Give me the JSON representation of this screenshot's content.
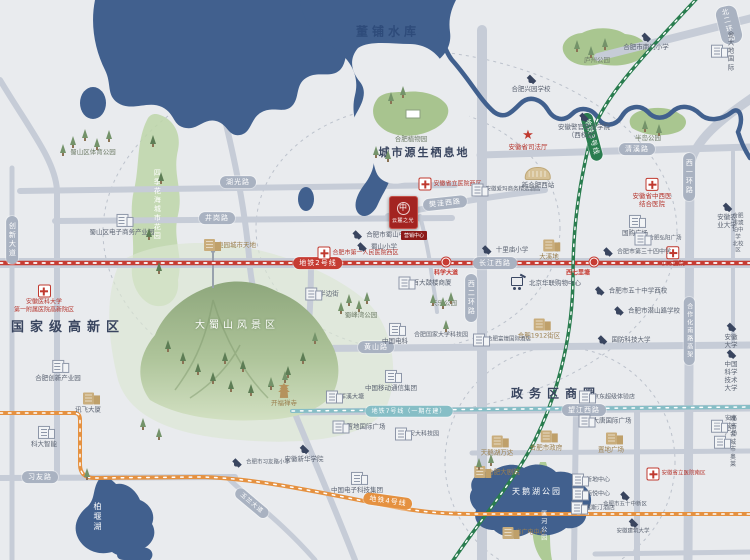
{
  "palette": {
    "land": "#e9ebee",
    "water": "#41608e",
    "road": "#c6ccd7",
    "green": "#aecb96",
    "metro2_red": "#c63c33",
    "metro3_green": "#2a7d4f",
    "metro4_orange": "#e59140",
    "metro7_teal": "#86bec6",
    "pill_gray": "#a9b2c1",
    "navy_text": "#39455f",
    "hospital_red": "#b5342c",
    "tan": "#c9ad7c"
  },
  "project": {
    "logo_mark": "中",
    "logo_title": "云麓之光",
    "tag": "营销中心"
  },
  "labels": [
    {
      "t": "董铺水库",
      "x": 388,
      "y": 32,
      "c": "water-big",
      "n": "dongpu-reservoir-label"
    },
    {
      "t": "城市源生栖息地",
      "x": 424,
      "y": 153,
      "c": "habitat",
      "n": "habitat-label"
    },
    {
      "t": "国家级高新区",
      "x": 68,
      "y": 328,
      "c": "area",
      "n": "hitech-zone-label"
    },
    {
      "t": "政务区商圈",
      "x": 556,
      "y": 394,
      "c": "area",
      "fs": 12,
      "n": "government-district-label"
    },
    {
      "t": "大蜀山风景区",
      "x": 237,
      "y": 326,
      "c": "big-park",
      "n": "dashushan-label"
    },
    {
      "t": "天鹅湖公园",
      "x": 537,
      "y": 492,
      "c": "wht sp2",
      "fs": 8,
      "n": "swan-lake-label"
    },
    {
      "t": "柏堰湖",
      "x": 97,
      "y": 517,
      "c": "wht v",
      "fs": 8,
      "n": "baiyan-lake-label"
    },
    {
      "t": "匡河公园",
      "x": 543,
      "y": 526,
      "c": "wht v",
      "fs": 6,
      "n": "kuanghe-park-label"
    },
    {
      "t": "四季花海城市花园",
      "x": 157,
      "y": 205,
      "c": "wht v",
      "fs": 7,
      "n": "flower-sea-garden-label"
    },
    {
      "t": "湖光路",
      "x": 238,
      "y": 182,
      "c": "pill",
      "n": "road-huguang-label"
    },
    {
      "t": "井岗路",
      "x": 217,
      "y": 218,
      "c": "pill",
      "n": "road-jinggang-label"
    },
    {
      "t": "长江西路",
      "x": 495,
      "y": 263,
      "c": "pill",
      "n": "road-changjiangxi-label"
    },
    {
      "t": "清溪路",
      "x": 637,
      "y": 149,
      "c": "pill",
      "n": "road-qingxi-label"
    },
    {
      "t": "樊洼西路",
      "x": 445,
      "y": 203,
      "c": "pill",
      "r": -6,
      "n": "road-fanwaxi-label"
    },
    {
      "t": "黄山路",
      "x": 376,
      "y": 347,
      "c": "pill",
      "n": "road-huangshan-label"
    },
    {
      "t": "望江西路",
      "x": 584,
      "y": 410,
      "c": "pill",
      "n": "road-wangjiangxi-label"
    },
    {
      "t": "习友路",
      "x": 40,
      "y": 477,
      "c": "pill",
      "n": "road-xiyou-label"
    },
    {
      "t": "北二环路",
      "x": 729,
      "y": 25,
      "c": "pill",
      "r": -14,
      "n": "road-beierhuan-label"
    },
    {
      "t": "西二环路",
      "x": 471,
      "y": 298,
      "c": "pill v",
      "n": "road-xierhuan-label"
    },
    {
      "t": "西一环路",
      "x": 689,
      "y": 177,
      "c": "pill v",
      "n": "road-xiyihuan-label"
    },
    {
      "t": "合作化南路高架",
      "x": 689,
      "y": 331,
      "c": "pill v",
      "fs": 6,
      "n": "road-hezuohua-label"
    },
    {
      "t": "创新大道",
      "x": 12,
      "y": 240,
      "c": "pill v",
      "n": "road-chuangxin-label"
    },
    {
      "t": "玉兰大道",
      "x": 252,
      "y": 503,
      "c": "pill",
      "r": 40,
      "fs": 6,
      "n": "road-yulan-label"
    },
    {
      "t": "地铁2号线",
      "x": 318,
      "y": 263,
      "c": "pill m2",
      "n": "metro-line2-badge"
    },
    {
      "t": "地铁3号线",
      "x": 592,
      "y": 137,
      "c": "pill m3",
      "r": 75,
      "n": "metro-line3-badge"
    },
    {
      "t": "地铁4号线",
      "x": 388,
      "y": 501,
      "c": "pill m4",
      "r": 8,
      "n": "metro-line4-badge"
    },
    {
      "t": "地铁7号线（一期在建）",
      "x": 409,
      "y": 411,
      "c": "pill m7",
      "fs": 6,
      "n": "metro-line7-badge"
    },
    {
      "t": "",
      "x": 446,
      "y": 262,
      "i": "stn",
      "n": "station-dot-kexuedadao"
    },
    {
      "t": "",
      "x": 594,
      "y": 262,
      "i": "stn",
      "n": "station-dot-xiqilitang"
    },
    {
      "t": "科学大道",
      "x": 446,
      "y": 273,
      "c": "stn-lbl",
      "n": "station-kexuedadao-label"
    },
    {
      "t": "西七里塘",
      "x": 578,
      "y": 273,
      "c": "stn-lbl",
      "n": "station-xiqilitang-label"
    },
    {
      "t": "安徽医科大学\n第一附属医院高新院区",
      "x": 44,
      "y": 299,
      "c": "red",
      "fs": 6,
      "i": "cross",
      "ip": "top",
      "n": "hospital-anyida-label"
    },
    {
      "t": "合肥市第一人民医院西区",
      "x": 358,
      "y": 253,
      "c": "red",
      "fs": 6,
      "i": "cross",
      "n": "hospital-first-people-label"
    },
    {
      "t": "安徽省立医院西区",
      "x": 450,
      "y": 184,
      "c": "red",
      "fs": 6,
      "i": "cross",
      "n": "hospital-shengli-west-label"
    },
    {
      "t": "安徽省中西医\n结合医院",
      "x": 652,
      "y": 193,
      "c": "red",
      "fs": 6.5,
      "i": "cross",
      "ip": "top",
      "n": "hospital-zhongxiyi-label"
    },
    {
      "t": "105医院",
      "x": 673,
      "y": 257,
      "c": "red",
      "fs": 6,
      "i": "cross",
      "ip": "top",
      "n": "hospital-105-label"
    },
    {
      "t": "安徽省立医院南区",
      "x": 676,
      "y": 474,
      "c": "red",
      "fs": 5.5,
      "i": "cross",
      "n": "hospital-shengli-south-label"
    },
    {
      "t": "安徽省司法厅",
      "x": 528,
      "y": 140,
      "c": "red",
      "fs": 6.5,
      "i": "star",
      "ip": "top",
      "n": "justice-dept-label"
    },
    {
      "t": "合肥市南门小学",
      "x": 646,
      "y": 42,
      "i": "cap",
      "ip": "top",
      "n": "school-nanmen-label"
    },
    {
      "t": "合肥兴园学校",
      "x": 531,
      "y": 84,
      "i": "cap",
      "ip": "top",
      "n": "school-xingyuan-label"
    },
    {
      "t": "安徽警官职业学院\n（西校区）",
      "x": 584,
      "y": 126,
      "i": "cap",
      "ip": "top",
      "n": "school-police-college-label"
    },
    {
      "t": "合肥市蜀山中学",
      "x": 381,
      "y": 235,
      "i": "cap",
      "n": "school-shushan-middle-label"
    },
    {
      "t": "蜀山小学",
      "x": 376,
      "y": 247,
      "i": "cap",
      "n": "school-shushan-primary-label"
    },
    {
      "t": "十里庙小学",
      "x": 504,
      "y": 250,
      "i": "cap",
      "n": "school-shilimiao-label"
    },
    {
      "t": "合肥市第三十四中学",
      "x": 636,
      "y": 252,
      "fs": 6,
      "i": "cap",
      "n": "school-no34-label"
    },
    {
      "t": "合肥市五十中学西校",
      "x": 630,
      "y": 291,
      "i": "cap",
      "n": "school-no50-west-label"
    },
    {
      "t": "合肥市潜山路学校",
      "x": 646,
      "y": 311,
      "i": "cap",
      "n": "school-qianshanlu-label"
    },
    {
      "t": "国防科技大学",
      "x": 623,
      "y": 340,
      "i": "cap",
      "n": "school-guofang-label"
    },
    {
      "t": "安徽大学",
      "x": 731,
      "y": 336,
      "i": "cap",
      "ip": "top",
      "n": "school-anhui-univ-label"
    },
    {
      "t": "中国科学技术大学",
      "x": 731,
      "y": 371,
      "i": "cap",
      "ip": "top",
      "n": "school-ustc-label"
    },
    {
      "t": "安徽农业大学",
      "x": 727,
      "y": 216,
      "i": "cap",
      "ip": "top",
      "n": "school-annong-label"
    },
    {
      "t": "合肥市琥珀中学\n北校区",
      "x": 738,
      "y": 234,
      "fs": 5.5,
      "n": "school-hupo-label"
    },
    {
      "t": "安徽新华学院",
      "x": 304,
      "y": 454,
      "i": "cap",
      "ip": "top",
      "n": "school-xinhua-label"
    },
    {
      "t": "合肥市习友路小学",
      "x": 260,
      "y": 463,
      "fs": 5.5,
      "i": "cap",
      "n": "school-xiyoulu-label"
    },
    {
      "t": "合肥市五十中新区",
      "x": 625,
      "y": 500,
      "fs": 5.5,
      "i": "cap",
      "ip": "top",
      "n": "school-no50-new-label"
    },
    {
      "t": "安徽建筑大学",
      "x": 633,
      "y": 527,
      "fs": 5.5,
      "i": "cap",
      "ip": "top",
      "n": "school-anjian-label"
    },
    {
      "t": "蜀山区体育公园",
      "x": 93,
      "y": 152,
      "c": "park",
      "n": "sports-park-label"
    },
    {
      "t": "蜀山区电子商务产业园",
      "x": 122,
      "y": 225,
      "i": "bg1",
      "ip": "top",
      "n": "ecommerce-park-label"
    },
    {
      "t": "奥园城市天地",
      "x": 230,
      "y": 245,
      "c": "tan",
      "i": "bt1",
      "n": "aoyuan-label"
    },
    {
      "t": "合肥植物园",
      "x": 411,
      "y": 139,
      "c": "park",
      "n": "botanical-garden-label"
    },
    {
      "t": "新合肥西站",
      "x": 538,
      "y": 178,
      "i": "trainst",
      "ip": "top",
      "n": "hefei-west-station-label"
    },
    {
      "t": "安徽爱玛商务精选酒店",
      "x": 506,
      "y": 190,
      "fs": 5.5,
      "i": "bg1",
      "n": "hotel-aima-label"
    },
    {
      "t": "庐州公园",
      "x": 597,
      "y": 60,
      "c": "park",
      "n": "luzhou-park-label"
    },
    {
      "t": "半岛公园",
      "x": 648,
      "y": 138,
      "c": "park",
      "n": "bandao-park-label"
    },
    {
      "t": "金大地国际",
      "x": 724,
      "y": 51,
      "i": "bg1",
      "n": "jindadi-label"
    },
    {
      "t": "国购广场",
      "x": 635,
      "y": 226,
      "i": "bg1",
      "ip": "top",
      "n": "guogou-plaza-label"
    },
    {
      "t": "合肥弘阳广场",
      "x": 658,
      "y": 239,
      "fs": 5.5,
      "i": "bg1",
      "n": "hongyang-plaza-label"
    },
    {
      "t": "大溪地",
      "x": 549,
      "y": 250,
      "c": "tan",
      "i": "bt1",
      "ip": "top",
      "n": "daxidi-label"
    },
    {
      "t": "天鹅湖万达",
      "x": 497,
      "y": 446,
      "c": "tan",
      "i": "bt1",
      "ip": "top",
      "n": "wanda-label"
    },
    {
      "t": "合肥市政府",
      "x": 546,
      "y": 441,
      "c": "tan",
      "i": "bt1",
      "ip": "top",
      "n": "city-gov-label"
    },
    {
      "t": "合肥大剧院",
      "x": 497,
      "y": 472,
      "c": "tan",
      "i": "bt1",
      "n": "grand-theater-label"
    },
    {
      "t": "大唐国际广场",
      "x": 605,
      "y": 421,
      "i": "bg1",
      "n": "datang-plaza-label"
    },
    {
      "t": "置地广场",
      "x": 611,
      "y": 443,
      "c": "tan",
      "i": "bt1",
      "ip": "top",
      "n": "zhidi-plaza-label"
    },
    {
      "t": "京东超级体验店",
      "x": 607,
      "y": 397,
      "fs": 6,
      "i": "bg1",
      "n": "jd-store-label"
    },
    {
      "t": "安高城市广场",
      "x": 724,
      "y": 426,
      "fs": 6,
      "i": "bg1",
      "n": "angao-plaza-label"
    },
    {
      "t": "唯品会城市奥莱",
      "x": 726,
      "y": 442,
      "fs": 6,
      "i": "bg1",
      "n": "vip-outlet-label"
    },
    {
      "t": "新地中心",
      "x": 591,
      "y": 480,
      "fs": 6,
      "i": "bg1",
      "n": "xindi-center-label"
    },
    {
      "t": "栢悦中心",
      "x": 591,
      "y": 494,
      "fs": 6,
      "i": "bg1",
      "n": "boyue-center-label"
    },
    {
      "t": "威斯汀酒店",
      "x": 593,
      "y": 508,
      "fs": 6,
      "i": "bg1",
      "n": "westin-label"
    },
    {
      "t": "省广电中心",
      "x": 524,
      "y": 533,
      "c": "tan",
      "fs": 6,
      "i": "bt1",
      "n": "broadcast-center-label"
    },
    {
      "t": "北京华联购物中心",
      "x": 546,
      "y": 283,
      "i": "cart",
      "n": "hualian-mall-label"
    },
    {
      "t": "合肥1912街区",
      "x": 539,
      "y": 329,
      "c": "tan",
      "i": "bt1",
      "ip": "top",
      "n": "hefei1912-label"
    },
    {
      "t": "合肥富煌国际酒店",
      "x": 502,
      "y": 340,
      "fs": 5.5,
      "i": "bg1",
      "n": "fuhuang-hotel-label"
    },
    {
      "t": "百大鼓楼商厦",
      "x": 425,
      "y": 283,
      "i": "bg1",
      "n": "baida-gulou-label"
    },
    {
      "t": "半边街",
      "x": 322,
      "y": 294,
      "i": "bg1",
      "n": "banbianjie-label"
    },
    {
      "t": "蜀峰湾公园",
      "x": 361,
      "y": 315,
      "c": "park",
      "n": "shufengwan-park-label"
    },
    {
      "t": "天乐公园",
      "x": 444,
      "y": 303,
      "c": "park",
      "n": "tianle-park-label"
    },
    {
      "t": "中国电科",
      "x": 395,
      "y": 334,
      "i": "bg1",
      "ip": "top",
      "n": "cetc-label"
    },
    {
      "t": "合肥国家大学科技园",
      "x": 441,
      "y": 335,
      "fs": 6,
      "n": "univ-sci-park-label"
    },
    {
      "t": "中国移动通信集团",
      "x": 391,
      "y": 381,
      "i": "bg1",
      "ip": "top",
      "n": "china-mobile-label"
    },
    {
      "t": "开福禅寺",
      "x": 284,
      "y": 395,
      "c": "tan",
      "i": "pagoda",
      "ip": "top",
      "n": "kaifu-temple-label"
    },
    {
      "t": "浑溪大塘",
      "x": 345,
      "y": 397,
      "fs": 6,
      "i": "bg1",
      "n": "hunxi-pond-label"
    },
    {
      "t": "合肥创新产业园",
      "x": 58,
      "y": 371,
      "i": "bg1",
      "ip": "top",
      "n": "innovation-park-label"
    },
    {
      "t": "讯飞大厦",
      "x": 88,
      "y": 403,
      "i": "bt1",
      "ip": "top",
      "n": "iflytek-label"
    },
    {
      "t": "科大智能",
      "x": 44,
      "y": 437,
      "i": "bg1",
      "ip": "top",
      "n": "keda-intelligent-label"
    },
    {
      "t": "置地国际广场",
      "x": 359,
      "y": 427,
      "i": "bg1",
      "n": "zhidi-intl-plaza-label"
    },
    {
      "t": "安大科技园",
      "x": 417,
      "y": 434,
      "fs": 6,
      "i": "bg1",
      "n": "anda-sci-park-label"
    },
    {
      "t": "中国电子科技集团",
      "x": 357,
      "y": 483,
      "i": "bg1",
      "ip": "top",
      "n": "cetc-group-label"
    }
  ],
  "trees": [
    [
      70,
      136
    ],
    [
      82,
      129
    ],
    [
      94,
      138
    ],
    [
      106,
      130
    ],
    [
      60,
      144
    ],
    [
      150,
      135,
      1
    ],
    [
      158,
      172,
      1
    ],
    [
      146,
      228,
      1
    ],
    [
      156,
      262,
      1
    ],
    [
      373,
      146
    ],
    [
      385,
      150
    ],
    [
      388,
      92
    ],
    [
      400,
      86
    ],
    [
      312,
      332
    ],
    [
      180,
      352,
      1
    ],
    [
      195,
      363,
      1
    ],
    [
      210,
      372,
      1
    ],
    [
      228,
      380,
      1
    ],
    [
      248,
      384,
      1
    ],
    [
      268,
      378,
      1
    ],
    [
      285,
      366,
      1
    ],
    [
      300,
      352,
      1
    ],
    [
      222,
      352,
      1
    ],
    [
      240,
      360,
      1
    ],
    [
      165,
      340,
      1
    ],
    [
      140,
      418
    ],
    [
      156,
      428
    ],
    [
      268,
      377
    ],
    [
      282,
      371
    ],
    [
      346,
      294
    ],
    [
      356,
      300
    ],
    [
      338,
      302
    ],
    [
      364,
      292
    ],
    [
      430,
      294
    ],
    [
      440,
      297
    ],
    [
      448,
      292
    ],
    [
      574,
      40
    ],
    [
      588,
      46
    ],
    [
      602,
      38
    ],
    [
      642,
      120
    ],
    [
      656,
      124
    ],
    [
      476,
      458
    ],
    [
      488,
      454
    ],
    [
      84,
      468
    ],
    [
      443,
      320
    ]
  ]
}
